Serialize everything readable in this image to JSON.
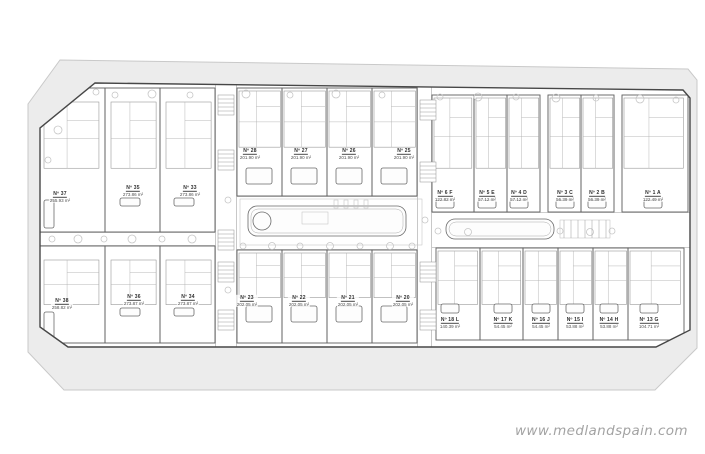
{
  "watermark": {
    "text": "www.medlandspain.com"
  },
  "plan": {
    "units": [
      {
        "id": "Nº 37",
        "area": "255.93 m²",
        "b": "LV",
        "x": 38,
        "y": 88,
        "w": 67,
        "h": 144,
        "lx": 60,
        "ly": 197,
        "pool": [
          44,
          200,
          10,
          28
        ]
      },
      {
        "id": "Nº 35",
        "area": "273.86 m²",
        "b": "LV",
        "x": 105,
        "y": 88,
        "w": 55,
        "h": 144,
        "lx": 133,
        "ly": 191,
        "pool": [
          120,
          198,
          20,
          8
        ]
      },
      {
        "id": "Nº 33",
        "area": "273.86 m²",
        "b": "LV",
        "x": 160,
        "y": 88,
        "w": 55,
        "h": 144,
        "lx": 190,
        "ly": 191,
        "pool": [
          174,
          198,
          20,
          8
        ]
      },
      {
        "id": "Nº 38",
        "area": "258.82 m²",
        "b": "LV",
        "x": 38,
        "y": 246,
        "w": 67,
        "h": 97,
        "lx": 62,
        "ly": 304,
        "pool": [
          44,
          312,
          10,
          26
        ]
      },
      {
        "id": "Nº 36",
        "area": "273.87 m²",
        "b": "LV",
        "x": 105,
        "y": 246,
        "w": 55,
        "h": 97,
        "lx": 134,
        "ly": 300,
        "pool": [
          120,
          308,
          20,
          8
        ]
      },
      {
        "id": "Nº 34",
        "area": "273.87 m²",
        "b": "LV",
        "x": 160,
        "y": 246,
        "w": 55,
        "h": 97,
        "lx": 188,
        "ly": 300,
        "pool": [
          174,
          308,
          20,
          8
        ]
      },
      {
        "id": "Nº 28",
        "area": "201.90 m²",
        "b": "CT",
        "x": 237,
        "y": 88,
        "w": 45,
        "h": 108,
        "lx": 250,
        "ly": 154,
        "pool": [
          246,
          168,
          26,
          16
        ]
      },
      {
        "id": "Nº 27",
        "area": "201.90 m²",
        "b": "CT",
        "x": 282,
        "y": 88,
        "w": 45,
        "h": 108,
        "lx": 301,
        "ly": 154,
        "pool": [
          291,
          168,
          26,
          16
        ]
      },
      {
        "id": "Nº 26",
        "area": "201.90 m²",
        "b": "CT",
        "x": 327,
        "y": 88,
        "w": 45,
        "h": 108,
        "lx": 349,
        "ly": 154,
        "pool": [
          336,
          168,
          26,
          16
        ]
      },
      {
        "id": "Nº 25",
        "area": "201.90 m²",
        "b": "CT",
        "x": 372,
        "y": 88,
        "w": 45,
        "h": 108,
        "lx": 404,
        "ly": 154,
        "pool": [
          381,
          168,
          26,
          16
        ]
      },
      {
        "id": "Nº 23",
        "area": "202.05 m²",
        "b": "CB",
        "x": 237,
        "y": 250,
        "w": 45,
        "h": 93,
        "lx": 247,
        "ly": 301,
        "pool": [
          246,
          306,
          26,
          16
        ]
      },
      {
        "id": "Nº 22",
        "area": "202.05 m²",
        "b": "CB",
        "x": 282,
        "y": 250,
        "w": 45,
        "h": 93,
        "lx": 299,
        "ly": 301,
        "pool": [
          291,
          306,
          26,
          16
        ]
      },
      {
        "id": "Nº 21",
        "area": "202.05 m²",
        "b": "CB",
        "x": 327,
        "y": 250,
        "w": 45,
        "h": 93,
        "lx": 348,
        "ly": 301,
        "pool": [
          336,
          306,
          26,
          16
        ]
      },
      {
        "id": "Nº 20",
        "area": "202.05 m²",
        "b": "CB",
        "x": 372,
        "y": 250,
        "w": 45,
        "h": 93,
        "lx": 403,
        "ly": 301,
        "pool": [
          381,
          306,
          26,
          16
        ]
      },
      {
        "id": "Nº 6 F",
        "area": "122.82 m²",
        "b": "RT",
        "x": 432,
        "y": 95,
        "w": 42,
        "h": 117,
        "lx": 445,
        "ly": 196,
        "pool": [
          436,
          200,
          18,
          8
        ]
      },
      {
        "id": "Nº 5 E",
        "area": "57.12 m²",
        "b": "RT",
        "x": 474,
        "y": 95,
        "w": 33,
        "h": 117,
        "lx": 487,
        "ly": 196,
        "pool": [
          478,
          200,
          18,
          8
        ]
      },
      {
        "id": "Nº 4 D",
        "area": "57.12 m²",
        "b": "RT",
        "x": 507,
        "y": 95,
        "w": 33,
        "h": 117,
        "lx": 519,
        "ly": 196,
        "pool": [
          510,
          200,
          18,
          8
        ]
      },
      {
        "id": "Nº 3 C",
        "area": "56.39 m²",
        "b": "RT",
        "x": 548,
        "y": 95,
        "w": 33,
        "h": 117,
        "lx": 565,
        "ly": 196,
        "pool": [
          556,
          200,
          18,
          8
        ]
      },
      {
        "id": "Nº 2 B",
        "area": "56.39 m²",
        "b": "RT",
        "x": 581,
        "y": 95,
        "w": 33,
        "h": 117,
        "lx": 597,
        "ly": 196,
        "pool": [
          588,
          200,
          18,
          8
        ]
      },
      {
        "id": "Nº 1 A",
        "area": "122.49 m²",
        "b": "RT",
        "x": 622,
        "y": 95,
        "w": 66,
        "h": 117,
        "lx": 653,
        "ly": 196,
        "pool": [
          644,
          200,
          18,
          8
        ]
      },
      {
        "id": "Nº 18 L",
        "area": "140.39 m²",
        "b": "RB",
        "x": 436,
        "y": 248,
        "w": 44,
        "h": 92,
        "lx": 450,
        "ly": 323,
        "pool": [
          441,
          304,
          18,
          9
        ]
      },
      {
        "id": "Nº 17 K",
        "area": "54.45 m²",
        "b": "RB",
        "x": 480,
        "y": 248,
        "w": 43,
        "h": 92,
        "lx": 503,
        "ly": 323,
        "pool": [
          494,
          304,
          18,
          9
        ]
      },
      {
        "id": "Nº 16 J",
        "area": "54.45 m²",
        "b": "RB",
        "x": 523,
        "y": 248,
        "w": 35,
        "h": 92,
        "lx": 541,
        "ly": 323,
        "pool": [
          532,
          304,
          18,
          9
        ]
      },
      {
        "id": "Nº 15 I",
        "area": "53.88 m²",
        "b": "RB",
        "x": 558,
        "y": 248,
        "w": 35,
        "h": 92,
        "lx": 575,
        "ly": 323,
        "pool": [
          566,
          304,
          18,
          9
        ]
      },
      {
        "id": "Nº 14 H",
        "area": "53.88 m²",
        "b": "RB",
        "x": 593,
        "y": 248,
        "w": 35,
        "h": 92,
        "lx": 609,
        "ly": 323,
        "pool": [
          600,
          304,
          18,
          9
        ]
      },
      {
        "id": "Nº 13 G",
        "area": "104.71 m²",
        "b": "RB",
        "x": 628,
        "y": 248,
        "w": 56,
        "h": 92,
        "lx": 649,
        "ly": 323,
        "pool": [
          640,
          304,
          18,
          9
        ]
      }
    ]
  }
}
